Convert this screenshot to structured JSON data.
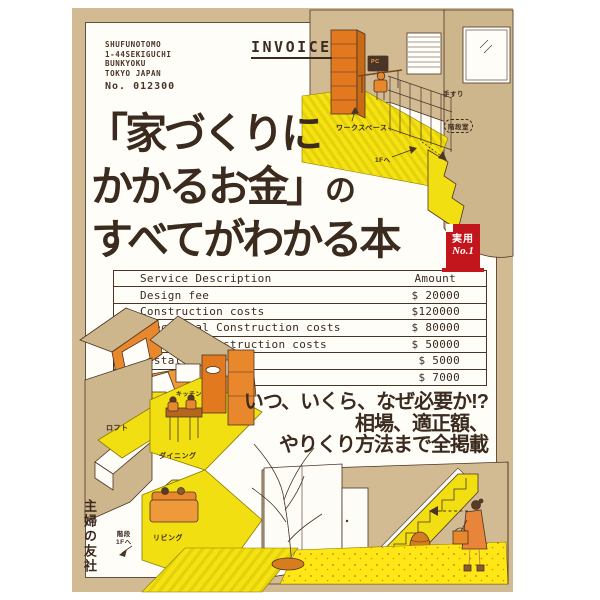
{
  "cover": {
    "colors": {
      "background_tan": "#d2bb93",
      "sheet_white": "#fffdf8",
      "accent_yellow": "#f2df12",
      "accent_orange": "#e8872c",
      "ink_brown": "#3b2a1e",
      "badge_red": "#c3161c"
    },
    "invoice_header": {
      "label": "INVOICE",
      "address_lines": [
        "SHUFUNOTOMO",
        "1-44SEKIGUCHI",
        "BUNKYOKU",
        "TOKYO JAPAN"
      ],
      "invoice_number": "No. 012300"
    },
    "title": {
      "line1": "「家づくりに",
      "line2_main": "かかるお金」",
      "line2_suffix": "の",
      "line3": "すべてがわかる本"
    },
    "badge": {
      "line1": "実用",
      "line2": "No.1"
    },
    "table": {
      "headers": {
        "description": "Service Description",
        "amount": "Amount"
      },
      "rows": [
        {
          "label": "Design fee",
          "amount": "$ 20000"
        },
        {
          "label": "Construction costs",
          "amount": "$120000"
        },
        {
          "label": "Electrical Construction costs",
          "amount": "$ 80000"
        },
        {
          "label": "Material Construction costs",
          "amount": "$ 50000"
        },
        {
          "label": "Installation fee",
          "amount": "$ 5000"
        },
        {
          "label": "Insurance fee",
          "amount": "$ 7000"
        }
      ]
    },
    "tagline": {
      "line1": "いつ、いくら、なぜ必要か!?",
      "line2": "相場、適正額、",
      "line3": "やりくり方法まで全掲載"
    },
    "illustration_labels": {
      "workspace": "ワークスペース",
      "to_1f": "1Fへ",
      "handrail": "手すり",
      "stairwell": "階段室",
      "pc": "PC",
      "loft": "ロフト",
      "kitchen": "キッチン",
      "dining": "ダイニング",
      "living": "リビング",
      "stairs": "階段",
      "stairs_to": "1Fへ"
    },
    "publisher": "主婦の友社"
  }
}
